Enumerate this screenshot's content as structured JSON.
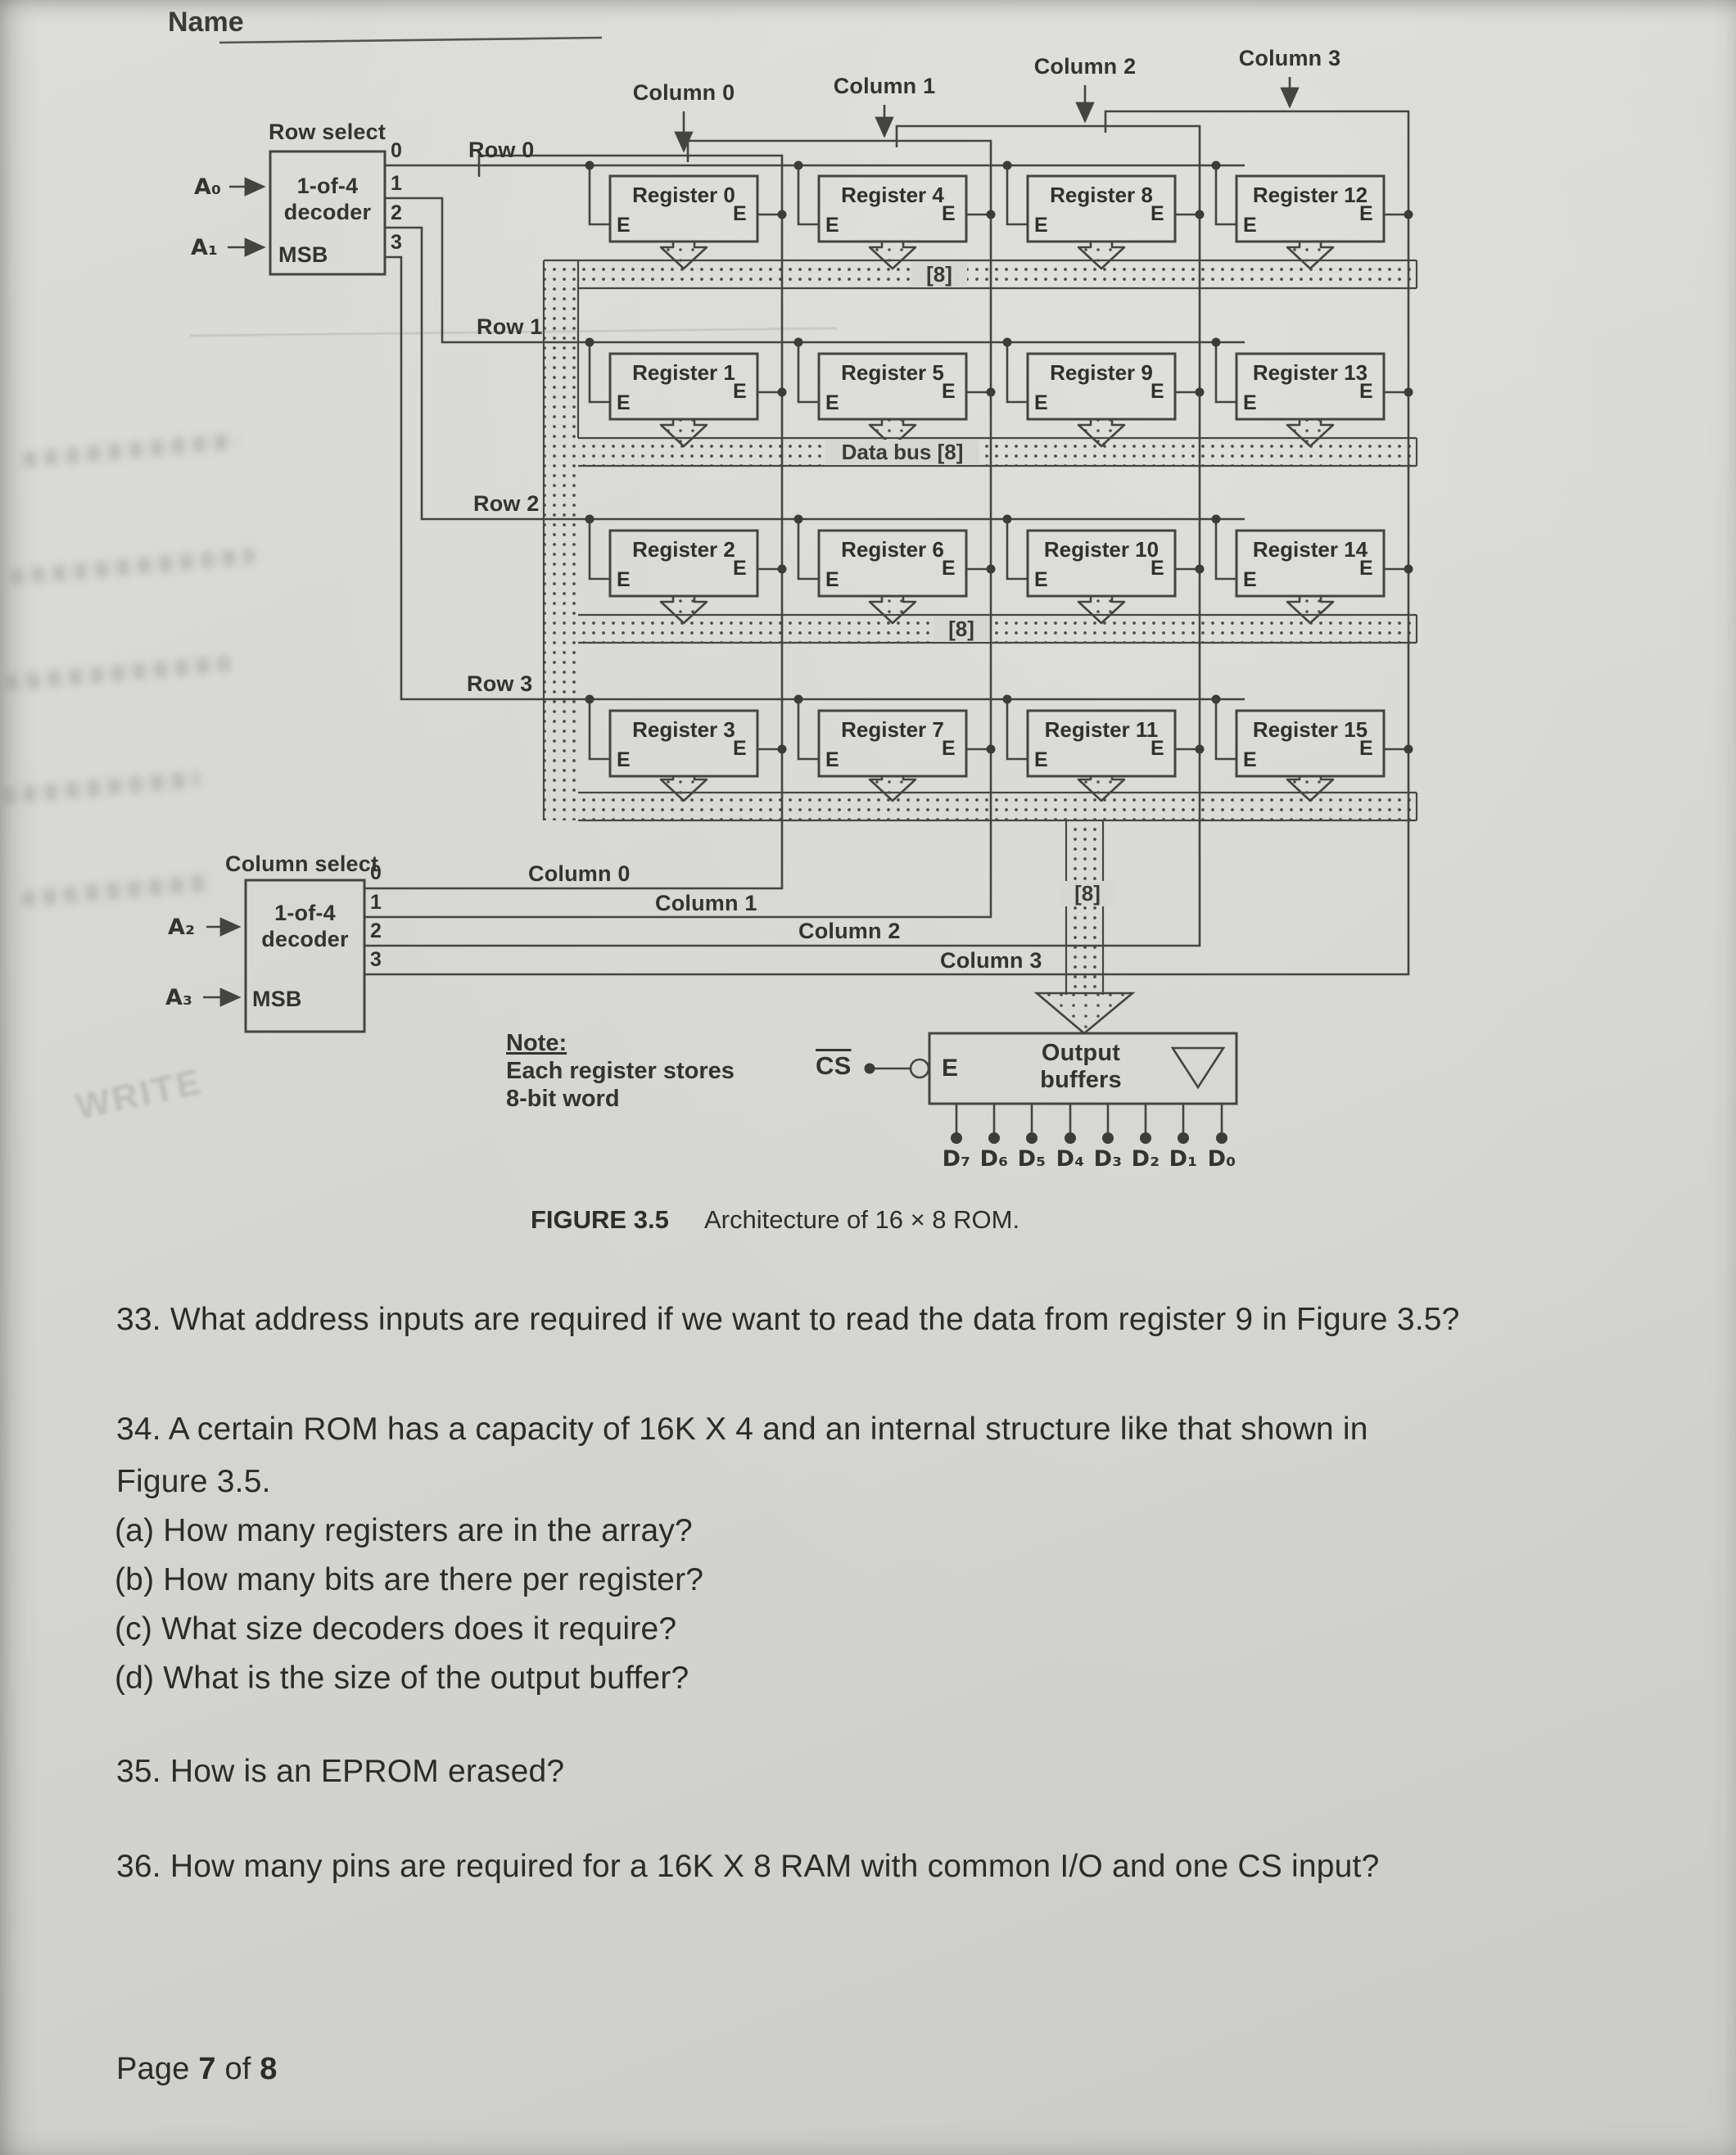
{
  "header": {
    "name_label": "Name"
  },
  "figure": {
    "row_decoder": {
      "title": "Row select",
      "line1": "1-of-4",
      "line2": "decoder",
      "msb": "MSB",
      "outputs": [
        "0",
        "1",
        "2",
        "3"
      ],
      "input_a0": "A₀",
      "input_a1": "A₁"
    },
    "column_decoder": {
      "title": "Column select",
      "line1": "1-of-4",
      "line2": "decoder",
      "msb": "MSB",
      "outputs": [
        "0",
        "1",
        "2",
        "3"
      ],
      "input_a2": "A₂",
      "input_a3": "A₃"
    },
    "row_labels": [
      "Row 0",
      "Row 1",
      "Row 2",
      "Row 3"
    ],
    "column_labels": [
      "Column 0",
      "Column 1",
      "Column 2",
      "Column 3"
    ],
    "registers": [
      "Register 0",
      "Register 1",
      "Register 2",
      "Register 3",
      "Register 4",
      "Register 5",
      "Register 6",
      "Register 7",
      "Register 8",
      "Register 9",
      "Register 10",
      "Register 11",
      "Register 12",
      "Register 13",
      "Register 14",
      "Register 15"
    ],
    "enable_label": "E",
    "bus": {
      "bus8": "[8]",
      "data_bus": "Data bus [8]"
    },
    "output_buffers": {
      "line1": "Output",
      "line2": "buffers",
      "enable": "E",
      "cs_label": "CS"
    },
    "data_outputs": [
      "D₇",
      "D₆",
      "D₅",
      "D₄",
      "D₃",
      "D₂",
      "D₁",
      "D₀"
    ],
    "note": {
      "title": "Note:",
      "line1": "Each register stores",
      "line2": "8-bit word"
    },
    "caption": {
      "tag": "FIGURE 3.5",
      "text": "Architecture of 16 × 8 ROM."
    }
  },
  "ghost": {
    "fragment": "WRITE"
  },
  "questions": {
    "q33": "33. What address inputs are required if we want to read the data from register 9 in Figure 3.5?",
    "q34_line1": "34. A certain ROM has a capacity of 16K X 4 and an internal structure like that shown in",
    "q34_line2": "Figure 3.5.",
    "q34a": "(a) How many registers are in the array?",
    "q34b": "(b) How many bits are there per register?",
    "q34c": "(c) What size decoders does it require?",
    "q34d": "(d) What is the size of the output buffer?",
    "q35": "35. How is an EPROM erased?",
    "q36": "36. How many pins are required for a 16K X 8 RAM with common I/O and one CS input?"
  },
  "footer": {
    "prefix": "Page",
    "page": "7",
    "of": "of",
    "total": "8"
  },
  "colors": {
    "paper": "#d6d6d2",
    "ink": "#2e2e2c",
    "line": "#4a4a44"
  }
}
